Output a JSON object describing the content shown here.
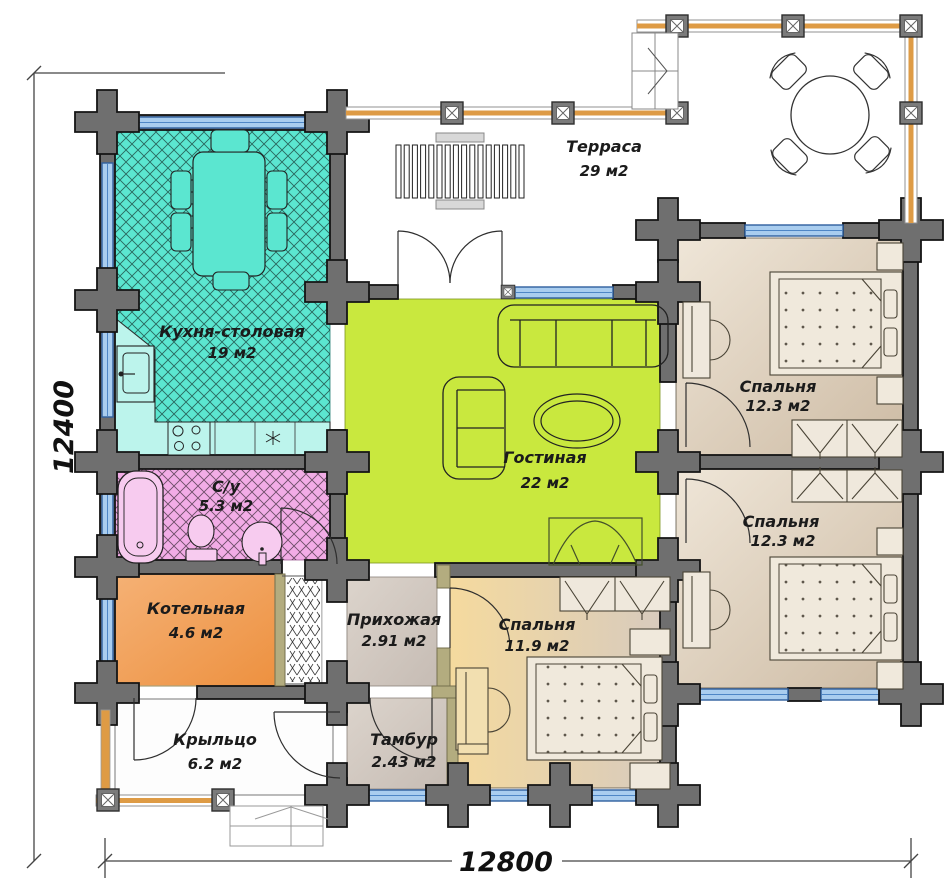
{
  "plan": {
    "rooms": [
      {
        "id": "kitchen",
        "name": "Кухня-столовая",
        "area": "19 м2"
      },
      {
        "id": "terrace",
        "name": "Терраса",
        "area": "29 м2"
      },
      {
        "id": "living",
        "name": "Гостиная",
        "area": "22 м2"
      },
      {
        "id": "bedroom-top",
        "name": "Спальня",
        "area": "12.3 м2"
      },
      {
        "id": "bedroom-bottom",
        "name": "Спальня",
        "area": "12.3 м2"
      },
      {
        "id": "bedroom-middle",
        "name": "Спальня",
        "area": "11.9 м2"
      },
      {
        "id": "bathroom",
        "name": "С/у",
        "area": "5.3 м2"
      },
      {
        "id": "boiler",
        "name": "Котельная",
        "area": "4.6 м2"
      },
      {
        "id": "hallway",
        "name": "Прихожая",
        "area": "2.91 м2"
      },
      {
        "id": "vestibule",
        "name": "Тамбур",
        "area": "2.43 м2"
      },
      {
        "id": "porch",
        "name": "Крыльцо",
        "area": "6.2 м2"
      }
    ],
    "dimensions": {
      "height_label": "12400",
      "width_label": "12800"
    },
    "colors": {
      "kitchen": "#5BE6D0",
      "kitchen_counter": "#BCF4EC",
      "living": "#C9E83E",
      "bathroom": "#F2ACE6",
      "fixture_pink": "#F7CBEF",
      "boiler": "#F09A50",
      "bedroom_beige": "#E6D9C6",
      "bedroom_warm": "#F2D9A2",
      "hall_grey": "#D2C9C1",
      "wall": "#6F6F6F",
      "partition": "#B3AC7F",
      "window": "#A9CDEF",
      "railing": "#DE9B45"
    }
  }
}
